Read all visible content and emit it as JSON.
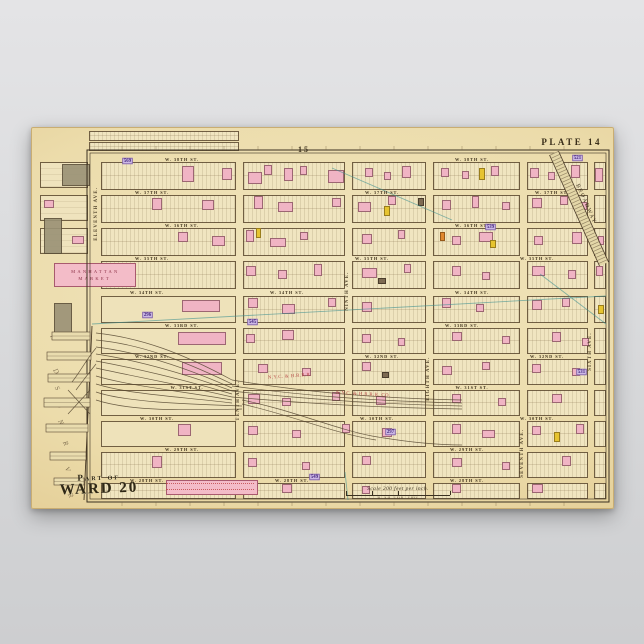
{
  "poster": {
    "plate_label": "PLATE 14",
    "adjacent_plate_top": "15",
    "adjacent_plate_bottom": "13",
    "ward_line1": "Part of",
    "ward_line2": "WARD 20",
    "market_line1": "MANHATTAN",
    "market_line2": "MARKET",
    "scale_text": "Scale 200 feet per inch.",
    "scale_ticks": "0    50   100       200",
    "river_word1": "HUDSON",
    "river_word2": "RIVER"
  },
  "colors": {
    "paper": "#ecdcab",
    "block_fill": "#f0e5c0",
    "line_brown": "#6e5a3a",
    "frame": "#3a3020",
    "pink_building": "#f0b4c4",
    "yellow_building": "#e6c430",
    "dark_building": "#7d6a52",
    "orange_building": "#e08830",
    "purple_badge_bg": "#cdb9e6",
    "purple_badge_text": "#42257a",
    "teal_annotation": "#3d9090",
    "red_text": "#b03838",
    "background_gray": "#d8d9db"
  },
  "map": {
    "frame": {
      "x1": 55,
      "y1": 22,
      "x2": 577,
      "y2": 374
    },
    "columns": [
      [
        69,
        204
      ],
      [
        211,
        313
      ],
      [
        320,
        394
      ],
      [
        401,
        488
      ],
      [
        495,
        556
      ],
      [
        562,
        574
      ]
    ],
    "yard_region": {
      "x1": 64,
      "x2": 206,
      "y1": 166,
      "y2": 302
    },
    "streets": [
      {
        "name": "W. 38th St.",
        "y": 29,
        "h": 5,
        "label_x": [
          150,
          440
        ]
      },
      {
        "name": "W. 37th St.",
        "y": 62,
        "h": 5,
        "label_x": [
          120,
          350,
          520
        ]
      },
      {
        "name": "W. 36th St.",
        "y": 95,
        "h": 5,
        "label_x": [
          150,
          440
        ]
      },
      {
        "name": "W. 35th St.",
        "y": 128,
        "h": 5,
        "label_x": [
          120,
          340,
          505
        ]
      },
      {
        "name": "W. 34th St.",
        "y": 161,
        "h": 7,
        "label_x": [
          115,
          255,
          440
        ]
      },
      {
        "name": "W. 33rd St.",
        "y": 195,
        "h": 5,
        "label_x": [
          150,
          430
        ]
      },
      {
        "name": "W. 32nd St.",
        "y": 226,
        "h": 5,
        "label_x": [
          120,
          350,
          515
        ]
      },
      {
        "name": "W. 31st St.",
        "y": 257,
        "h": 5,
        "label_x": [
          155,
          440
        ]
      },
      {
        "name": "W. 30th St.",
        "y": 288,
        "h": 5,
        "label_x": [
          125,
          345,
          505
        ]
      },
      {
        "name": "W. 29th St.",
        "y": 319,
        "h": 5,
        "label_x": [
          150,
          435
        ]
      },
      {
        "name": "W. 28th St.",
        "y": 350,
        "h": 5,
        "label_x": [
          115,
          260,
          435
        ]
      }
    ],
    "avenues": [
      {
        "name": "Eleventh Ave.",
        "x": 62,
        "w": 7,
        "label_y": 48
      },
      {
        "name": "Tenth Ave.",
        "x": 204,
        "w": 7,
        "label_y": 228
      },
      {
        "name": "Ninth Ave.",
        "x": 313,
        "w": 7,
        "label_y": 118
      },
      {
        "name": "Eighth Ave.",
        "x": 394,
        "w": 7,
        "label_y": 208
      },
      {
        "name": "Seventh Ave.",
        "x": 488,
        "w": 7,
        "label_y": 285
      },
      {
        "name": "Sixth Ave.",
        "x": 556,
        "w": 6,
        "label_y": 178
      }
    ],
    "stub_blocks": [
      [
        57,
        3,
        150,
        10
      ],
      [
        57,
        14,
        150,
        9
      ]
    ],
    "west_blocks": [
      [
        8,
        34,
        48,
        26
      ],
      [
        8,
        67,
        48,
        26
      ],
      [
        8,
        100,
        48,
        26
      ]
    ],
    "blobs": [
      [
        30,
        36,
        26,
        20
      ],
      [
        12,
        90,
        16,
        34
      ],
      [
        22,
        175,
        16,
        34
      ]
    ],
    "buildings": [
      [
        150,
        38,
        12,
        16,
        "p"
      ],
      [
        190,
        40,
        10,
        12,
        "p"
      ],
      [
        216,
        44,
        14,
        12,
        "p"
      ],
      [
        232,
        37,
        8,
        10,
        "p"
      ],
      [
        252,
        40,
        9,
        13,
        "p"
      ],
      [
        268,
        38,
        7,
        9,
        "p"
      ],
      [
        296,
        42,
        16,
        13,
        "p"
      ],
      [
        333,
        40,
        8,
        9,
        "p"
      ],
      [
        352,
        44,
        7,
        8,
        "p"
      ],
      [
        370,
        38,
        9,
        12,
        "p"
      ],
      [
        409,
        40,
        8,
        9,
        "p"
      ],
      [
        430,
        43,
        7,
        8,
        "p"
      ],
      [
        459,
        38,
        8,
        10,
        "p"
      ],
      [
        447,
        40,
        6,
        12,
        "y"
      ],
      [
        498,
        40,
        9,
        10,
        "p"
      ],
      [
        516,
        44,
        7,
        8,
        "p"
      ],
      [
        539,
        37,
        9,
        13,
        "p"
      ],
      [
        563,
        40,
        8,
        14,
        "p"
      ],
      [
        120,
        70,
        10,
        12,
        "p"
      ],
      [
        170,
        72,
        12,
        10,
        "p"
      ],
      [
        222,
        68,
        9,
        13,
        "p"
      ],
      [
        246,
        74,
        15,
        10,
        "p"
      ],
      [
        300,
        70,
        9,
        9,
        "p"
      ],
      [
        326,
        74,
        13,
        10,
        "p"
      ],
      [
        356,
        68,
        8,
        9,
        "p"
      ],
      [
        386,
        70,
        6,
        8,
        "d"
      ],
      [
        410,
        72,
        9,
        10,
        "p"
      ],
      [
        440,
        68,
        7,
        12,
        "p"
      ],
      [
        470,
        74,
        8,
        8,
        "p"
      ],
      [
        500,
        70,
        10,
        10,
        "p"
      ],
      [
        528,
        68,
        8,
        9,
        "p"
      ],
      [
        548,
        74,
        7,
        8,
        "p"
      ],
      [
        352,
        78,
        6,
        10,
        "y"
      ],
      [
        146,
        104,
        10,
        10,
        "p"
      ],
      [
        180,
        108,
        13,
        10,
        "p"
      ],
      [
        214,
        102,
        8,
        12,
        "p"
      ],
      [
        238,
        110,
        16,
        9,
        "p"
      ],
      [
        268,
        104,
        8,
        8,
        "p"
      ],
      [
        330,
        106,
        10,
        10,
        "p"
      ],
      [
        366,
        102,
        7,
        9,
        "p"
      ],
      [
        408,
        104,
        5,
        9,
        "o"
      ],
      [
        420,
        108,
        9,
        9,
        "p"
      ],
      [
        447,
        104,
        14,
        10,
        "p"
      ],
      [
        502,
        108,
        9,
        9,
        "p"
      ],
      [
        540,
        104,
        10,
        12,
        "p"
      ],
      [
        566,
        108,
        6,
        9,
        "p"
      ],
      [
        224,
        100,
        5,
        10,
        "y"
      ],
      [
        458,
        112,
        6,
        8,
        "y"
      ],
      [
        214,
        138,
        10,
        10,
        "p"
      ],
      [
        246,
        142,
        9,
        9,
        "p"
      ],
      [
        282,
        136,
        8,
        12,
        "p"
      ],
      [
        330,
        140,
        15,
        10,
        "p"
      ],
      [
        372,
        136,
        7,
        9,
        "p"
      ],
      [
        420,
        138,
        9,
        10,
        "p"
      ],
      [
        450,
        144,
        8,
        8,
        "p"
      ],
      [
        500,
        138,
        13,
        10,
        "p"
      ],
      [
        536,
        142,
        8,
        9,
        "p"
      ],
      [
        564,
        138,
        7,
        10,
        "p"
      ],
      [
        346,
        150,
        8,
        6,
        "d"
      ],
      [
        150,
        172,
        38,
        12,
        "p"
      ],
      [
        216,
        170,
        10,
        10,
        "p"
      ],
      [
        250,
        176,
        13,
        10,
        "p"
      ],
      [
        296,
        170,
        8,
        9,
        "p"
      ],
      [
        330,
        174,
        10,
        10,
        "p"
      ],
      [
        410,
        170,
        9,
        10,
        "p"
      ],
      [
        444,
        176,
        8,
        8,
        "p"
      ],
      [
        500,
        172,
        10,
        10,
        "p"
      ],
      [
        530,
        170,
        8,
        9,
        "p"
      ],
      [
        566,
        177,
        6,
        9,
        "y"
      ],
      [
        146,
        204,
        48,
        13,
        "p"
      ],
      [
        214,
        206,
        9,
        9,
        "p"
      ],
      [
        250,
        202,
        12,
        10,
        "p"
      ],
      [
        330,
        206,
        9,
        9,
        "p"
      ],
      [
        366,
        210,
        7,
        8,
        "p"
      ],
      [
        420,
        204,
        10,
        9,
        "p"
      ],
      [
        470,
        208,
        8,
        8,
        "p"
      ],
      [
        520,
        204,
        9,
        10,
        "p"
      ],
      [
        550,
        210,
        7,
        8,
        "p"
      ],
      [
        150,
        234,
        40,
        13,
        "p"
      ],
      [
        226,
        236,
        10,
        9,
        "p"
      ],
      [
        270,
        240,
        9,
        8,
        "p"
      ],
      [
        330,
        234,
        9,
        9,
        "p"
      ],
      [
        350,
        244,
        7,
        6,
        "d"
      ],
      [
        410,
        238,
        10,
        9,
        "p"
      ],
      [
        450,
        234,
        8,
        8,
        "p"
      ],
      [
        500,
        236,
        9,
        9,
        "p"
      ],
      [
        540,
        240,
        8,
        8,
        "p"
      ],
      [
        216,
        266,
        12,
        10,
        "p"
      ],
      [
        250,
        270,
        9,
        8,
        "p"
      ],
      [
        300,
        264,
        8,
        9,
        "p"
      ],
      [
        344,
        268,
        10,
        9,
        "p"
      ],
      [
        420,
        266,
        9,
        9,
        "p"
      ],
      [
        466,
        270,
        8,
        8,
        "p"
      ],
      [
        520,
        266,
        10,
        9,
        "p"
      ],
      [
        146,
        296,
        13,
        12,
        "p"
      ],
      [
        216,
        298,
        10,
        9,
        "p"
      ],
      [
        260,
        302,
        9,
        8,
        "p"
      ],
      [
        310,
        296,
        8,
        9,
        "p"
      ],
      [
        350,
        300,
        10,
        9,
        "p"
      ],
      [
        420,
        296,
        9,
        10,
        "p"
      ],
      [
        450,
        302,
        13,
        8,
        "p"
      ],
      [
        500,
        298,
        9,
        9,
        "p"
      ],
      [
        544,
        296,
        8,
        10,
        "p"
      ],
      [
        522,
        304,
        6,
        10,
        "y"
      ],
      [
        120,
        328,
        10,
        12,
        "p"
      ],
      [
        216,
        330,
        9,
        9,
        "p"
      ],
      [
        270,
        334,
        8,
        8,
        "p"
      ],
      [
        330,
        328,
        9,
        9,
        "p"
      ],
      [
        420,
        330,
        10,
        9,
        "p"
      ],
      [
        470,
        334,
        8,
        8,
        "p"
      ],
      [
        530,
        328,
        9,
        10,
        "p"
      ],
      [
        250,
        356,
        10,
        9,
        "p"
      ],
      [
        330,
        358,
        8,
        8,
        "p"
      ],
      [
        420,
        356,
        9,
        9,
        "p"
      ],
      [
        500,
        356,
        11,
        9,
        "p"
      ],
      [
        66,
        150,
        10,
        8,
        "p"
      ],
      [
        12,
        72,
        10,
        8,
        "p"
      ],
      [
        40,
        108,
        12,
        8,
        "p"
      ]
    ],
    "badges": [
      [
        89,
        29,
        "569"
      ],
      [
        109,
        183,
        "296"
      ],
      [
        214,
        190,
        "545"
      ],
      [
        276,
        345,
        "549"
      ],
      [
        539,
        26,
        "521"
      ],
      [
        352,
        300,
        "297"
      ],
      [
        452,
        95,
        "539"
      ],
      [
        543,
        240,
        "531"
      ]
    ],
    "red_labels": [
      [
        236,
        247,
        -4,
        "N.Y.C. & H.R.R.R."
      ],
      [
        304,
        262,
        3,
        "N.Y.C. & H.R.R.R. CO."
      ]
    ],
    "railroad": {
      "paths": [
        "M64,205 C110,210 150,225 200,252",
        "M64,212 C108,216 150,232 200,256",
        "M64,219 C106,224 150,238 200,260",
        "M64,226 C104,232 148,244 200,263",
        "M64,233 C102,240 146,250 200,266",
        "M64,240 C100,248 144,256 200,269",
        "M64,248 C98,258 142,262 200,272",
        "M64,256 C96,266 140,268 200,275",
        "M64,264 C94,274 150,276 210,278",
        "M64,272 C100,284 160,282 210,281",
        "M200,252 C260,262 330,270 430,272",
        "M200,258 C260,266 330,273 430,275",
        "M200,263 C270,271 340,276 430,278",
        "M200,269 C280,276 350,280 430,281",
        "M210,272 C260,282 300,300 340,308 C380,315 410,317 430,317",
        "M210,276 C262,288 304,306 344,312",
        "M64,220 C54,232 48,244 40,254",
        "M64,236 C56,246 50,254 44,262",
        "M36,262 L58,286",
        "M58,262 L36,286"
      ]
    },
    "broadway": {
      "label": "BROADWAY",
      "x1": 522,
      "y1": 25,
      "x2": 572,
      "y2": 136
    },
    "teal_lines": [
      [
        60,
        196,
        574,
        168
      ],
      [
        300,
        40,
        420,
        92
      ],
      [
        508,
        146,
        574,
        196
      ],
      [
        313,
        344,
        316,
        372
      ]
    ],
    "piers": [
      [
        20,
        204,
        38,
        8
      ],
      [
        15,
        224,
        44,
        8
      ],
      [
        16,
        246,
        42,
        8
      ],
      [
        12,
        270,
        46,
        9
      ],
      [
        14,
        296,
        42,
        8
      ],
      [
        18,
        324,
        36,
        8
      ],
      [
        22,
        350,
        30,
        7
      ]
    ],
    "river_letters": {
      "word1_x": 18,
      "word1_y0": 206,
      "word1_dy": 17,
      "word2_x": 31,
      "word2_y0": 312,
      "word2_dy": 13
    }
  }
}
